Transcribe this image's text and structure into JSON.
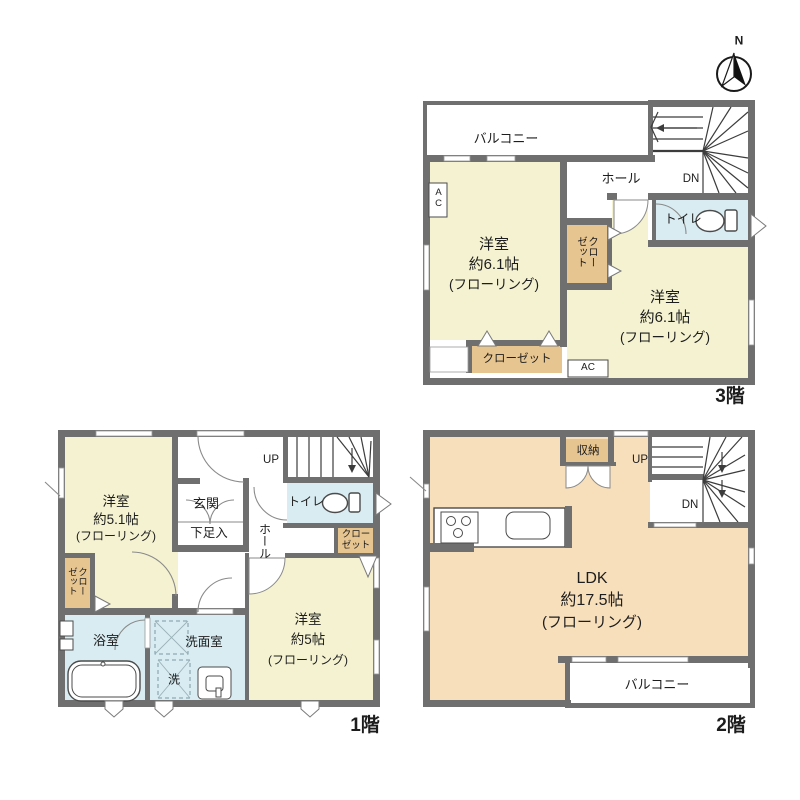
{
  "colors": {
    "wall": "#6f6f6f",
    "room_yellow": "#f4f2d1",
    "room_peach": "#f8dfbb",
    "room_blue": "#d9ecf2",
    "closet_tan": "#e7c590",
    "stair_line": "#3c3c3c"
  },
  "compass": {
    "north": "N"
  },
  "floor3": {
    "name": "3階",
    "balcony": "バルコニー",
    "hall": "ホール",
    "down": "DN",
    "toilet": "トイレ",
    "room_left": {
      "l1": "洋室",
      "l2": "約6.1帖",
      "l3": "(フローリング)"
    },
    "room_right": {
      "l1": "洋室",
      "l2": "約6.1帖",
      "l3": "(フローリング)"
    },
    "closet_between": "クローゼット",
    "closet_bottom": "クローゼット",
    "ac_left": "AC",
    "ac_bottom": "AC"
  },
  "floor2": {
    "name": "2階",
    "storage": "収納",
    "up": "UP",
    "down": "DN",
    "ldk": {
      "l1": "LDK",
      "l2": "約17.5帖",
      "l3": "(フローリング)"
    },
    "balcony": "バルコニー"
  },
  "floor1": {
    "name": "1階",
    "up": "UP",
    "toilet": "トイレ",
    "hall": "ホール",
    "entrance": "玄関",
    "shoe_box": "下足入",
    "room_upper_left": {
      "l1": "洋室",
      "l2": "約5.1帖",
      "l3": "(フローリング)"
    },
    "room_lower_right": {
      "l1": "洋室",
      "l2": "約5帖",
      "l3": "(フローリング)"
    },
    "closet_left": "クローゼット",
    "closet_right": "クローゼット",
    "bathroom": "浴室",
    "washroom": "洗面室",
    "laundry": "洗"
  }
}
